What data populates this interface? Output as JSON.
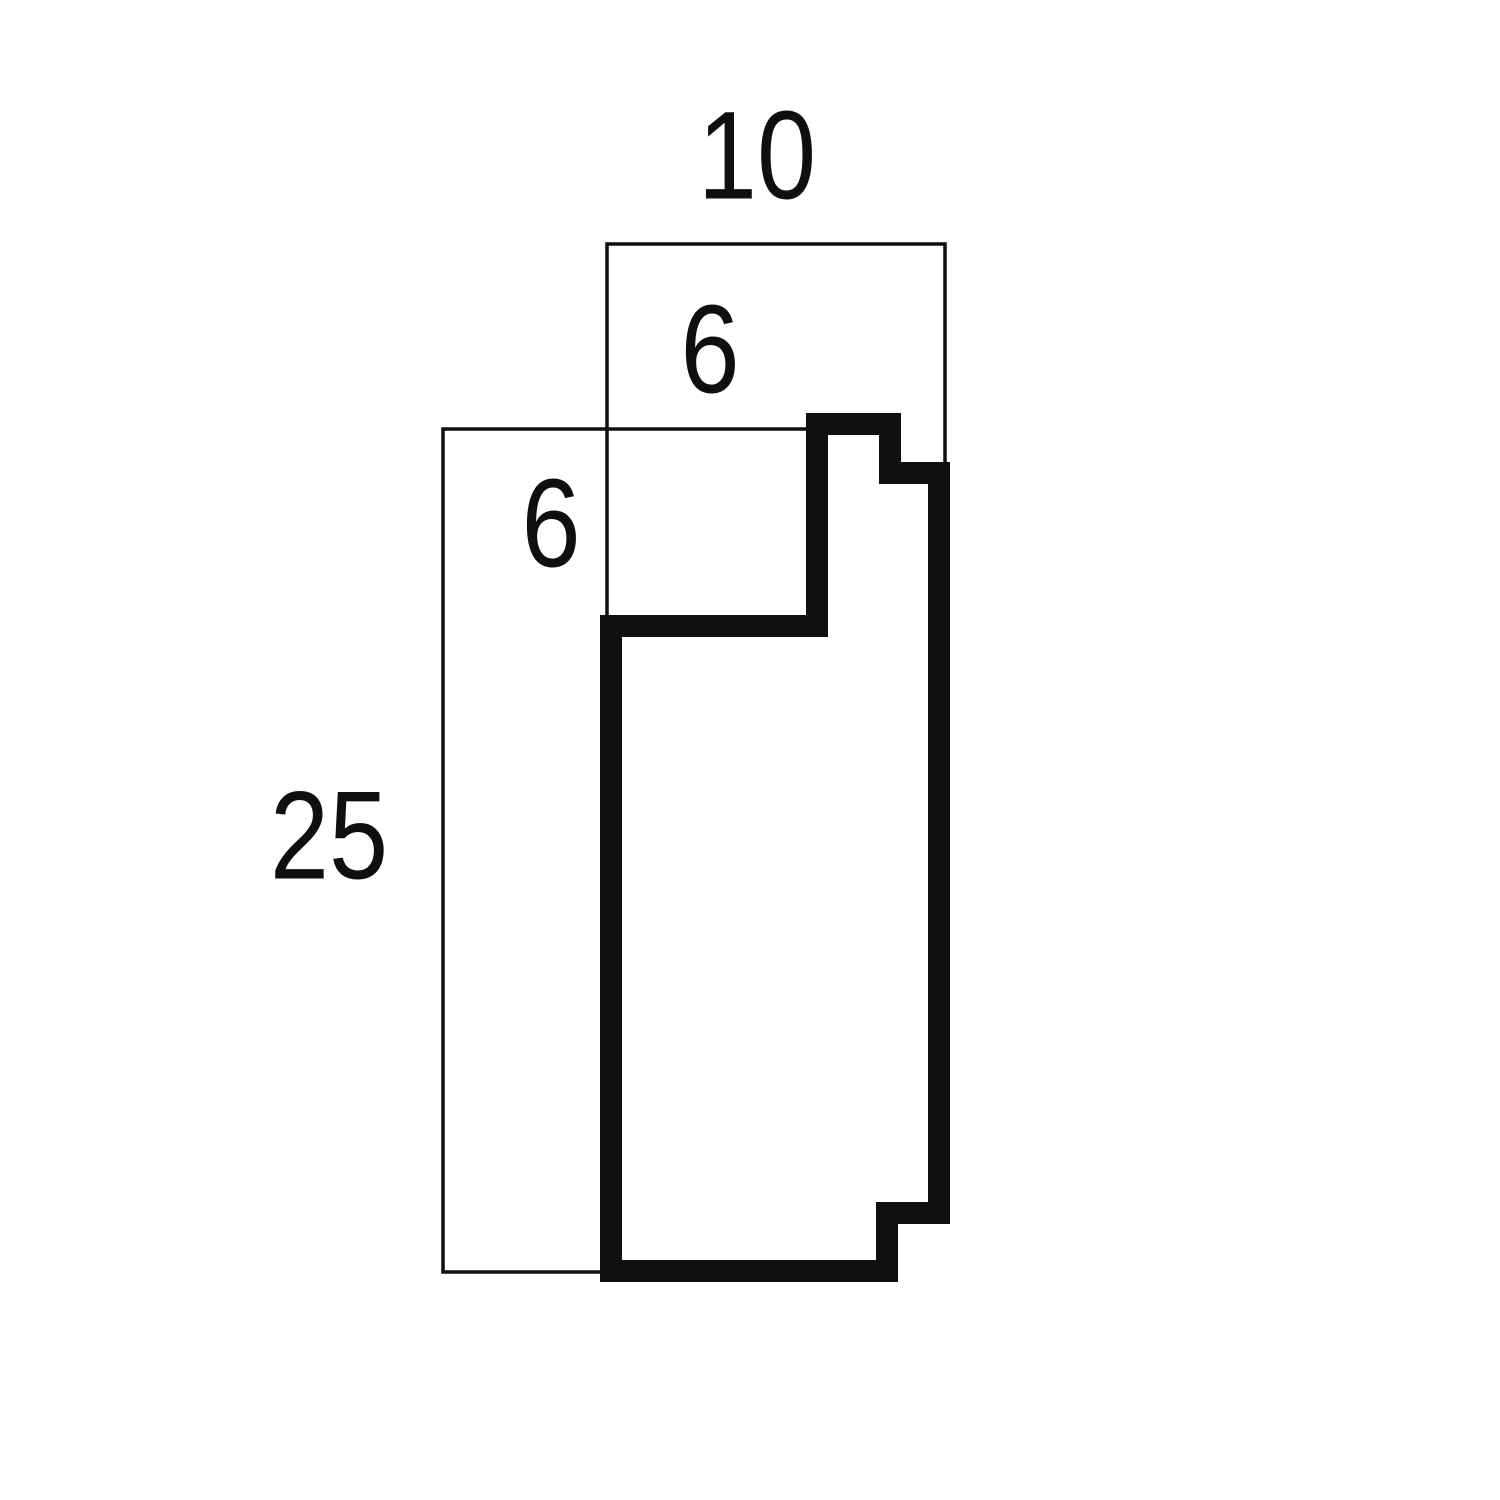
{
  "diagram": {
    "dimensions": {
      "width": "10",
      "rabbet_height": "6",
      "rabbet_width": "6",
      "height": "25"
    },
    "colors": {
      "line": "#0f0f0f",
      "background": "#ffffff"
    }
  }
}
